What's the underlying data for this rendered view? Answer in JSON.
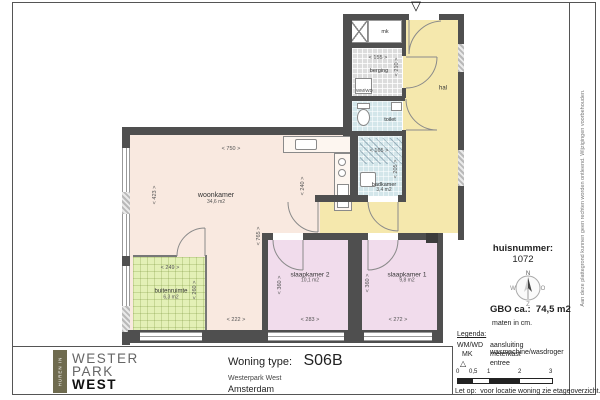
{
  "plan": {
    "entree_icon": "▽",
    "rooms": {
      "woonkamer": {
        "name": "woonkamer",
        "area": "34,6 m2"
      },
      "slaapkamer2": {
        "name": "slaapkamer 2",
        "area": "10,1 m2"
      },
      "slaapkamer1": {
        "name": "slaapkamer 1",
        "area": "9,8 m2"
      },
      "badkamer": {
        "name": "badkamer",
        "area": "3,4 m2"
      },
      "buitenruimte": {
        "name": "buitenruimte",
        "area": "6,3 m2"
      },
      "berging": {
        "name": "berging"
      },
      "toilet": {
        "name": "toilet"
      },
      "hal": {
        "name": "hal"
      },
      "mk": {
        "name": "mk"
      },
      "wasmachine": {
        "name": "WM/WD"
      }
    },
    "dims": {
      "woonkamer_breedte": "< 750 >",
      "woonkamer_diepte": "< 423 >",
      "keuken_diepte": "< 240 >",
      "woonkamer_diepte2": "< 765 >",
      "strook_breedte": "< 222 >",
      "buitenruimte_breedte": "< 249 >",
      "buitenruimte_diepte": "< 260 >",
      "slaapkamer2_breedte": "< 283 >",
      "slaapkamer1_breedte": "< 272 >",
      "slaapkamer2_diepte": "< 360 >",
      "slaapkamer1_diepte": "< 360 >",
      "berging_breedte": "< 155 >",
      "berging_diepte": "< 210 >",
      "badkamer_breedte": "< 165 >",
      "badkamer_diepte": "< 205 >"
    }
  },
  "info_panel": {
    "huisnummer_label": "huisnummer:",
    "huisnummer": "1072",
    "compass": {
      "north": "N",
      "east": "O",
      "south": "Z",
      "west": "W"
    },
    "gbo": "GBO ca.:  74,5 m2",
    "maten": "maten in cm.",
    "legend": {
      "title": "Legenda:",
      "items": [
        {
          "key": "WM/WD",
          "value": "aansluiting wasmachine/wasdroger"
        },
        {
          "key": "MK",
          "value": "meterkast"
        },
        {
          "key": "△",
          "value": "entree"
        }
      ]
    },
    "scale_ticks": [
      "0",
      "0,5",
      "1",
      "2",
      "3"
    ],
    "note": "Let op:  voor locatie woning zie etageoverzicht."
  },
  "title_block": {
    "logo": {
      "vertical_text": "HUREN IN",
      "line1": "WESTER",
      "line2": "PARK",
      "line3": "WEST"
    },
    "type_label": "Woning type:",
    "type_value": "S06B",
    "project": "Westerpark West",
    "city": "Amsterdam"
  },
  "disclaimer": "Aan deze plattegrond kunnen geen rechten worden ontleend. Wijzigingen voorbehouden."
}
